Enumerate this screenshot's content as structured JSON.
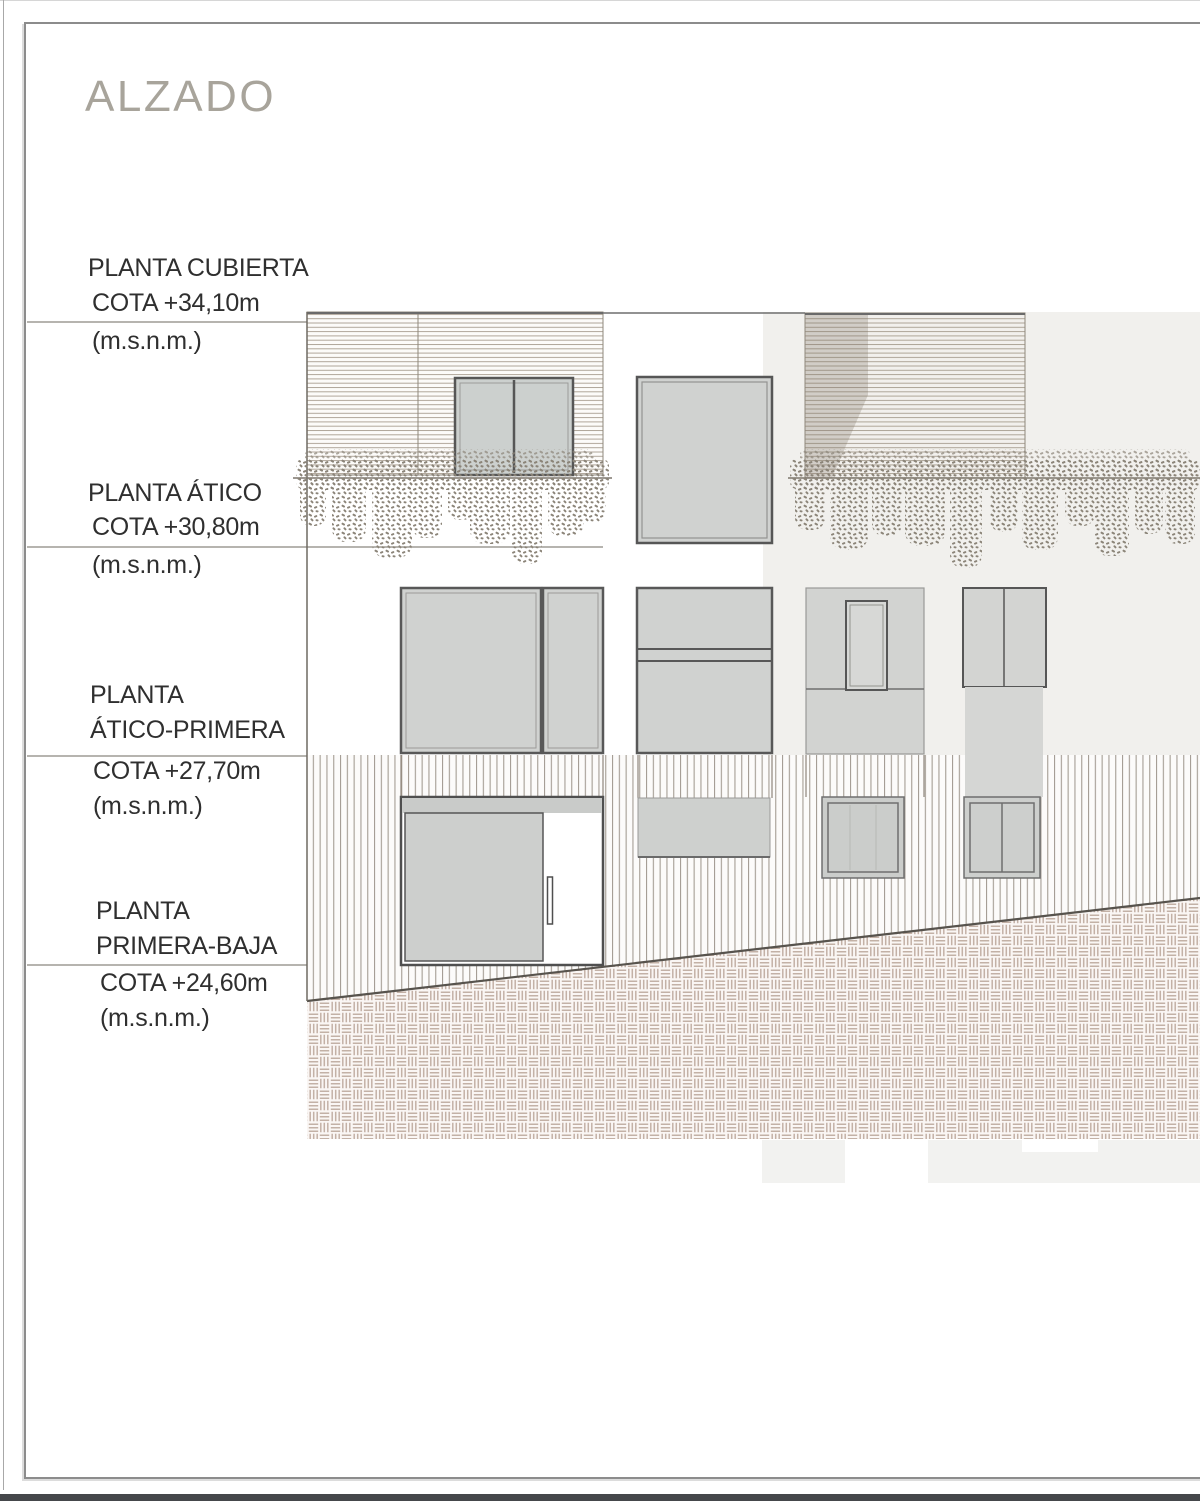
{
  "title": "ALZADO",
  "levels": [
    {
      "name1": "PLANTA CUBIERTA",
      "name2": "",
      "cota": "COTA +34,10m",
      "unit": "(m.s.n.m.)"
    },
    {
      "name1": "PLANTA ÁTICO",
      "name2": "",
      "cota": "COTA +30,80m",
      "unit": "(m.s.n.m.)"
    },
    {
      "name1": "PLANTA",
      "name2": "ÁTICO-PRIMERA",
      "cota": "COTA +27,70m",
      "unit": "(m.s.n.m.)"
    },
    {
      "name1": "PLANTA",
      "name2": "PRIMERA-BAJA",
      "cota": "COTA +24,60m",
      "unit": "(m.s.n.m.)"
    }
  ],
  "colors": {
    "title_text": "#a8a49b",
    "label_text": "#2f2f2f",
    "window_fill": "#d0d2d0",
    "window_border": "#565656",
    "facade_stripe": "#9a9183",
    "paving_line": "#c3b1a6",
    "backdrop": "#f1f0ed",
    "bottom_bar": "#45474b"
  }
}
